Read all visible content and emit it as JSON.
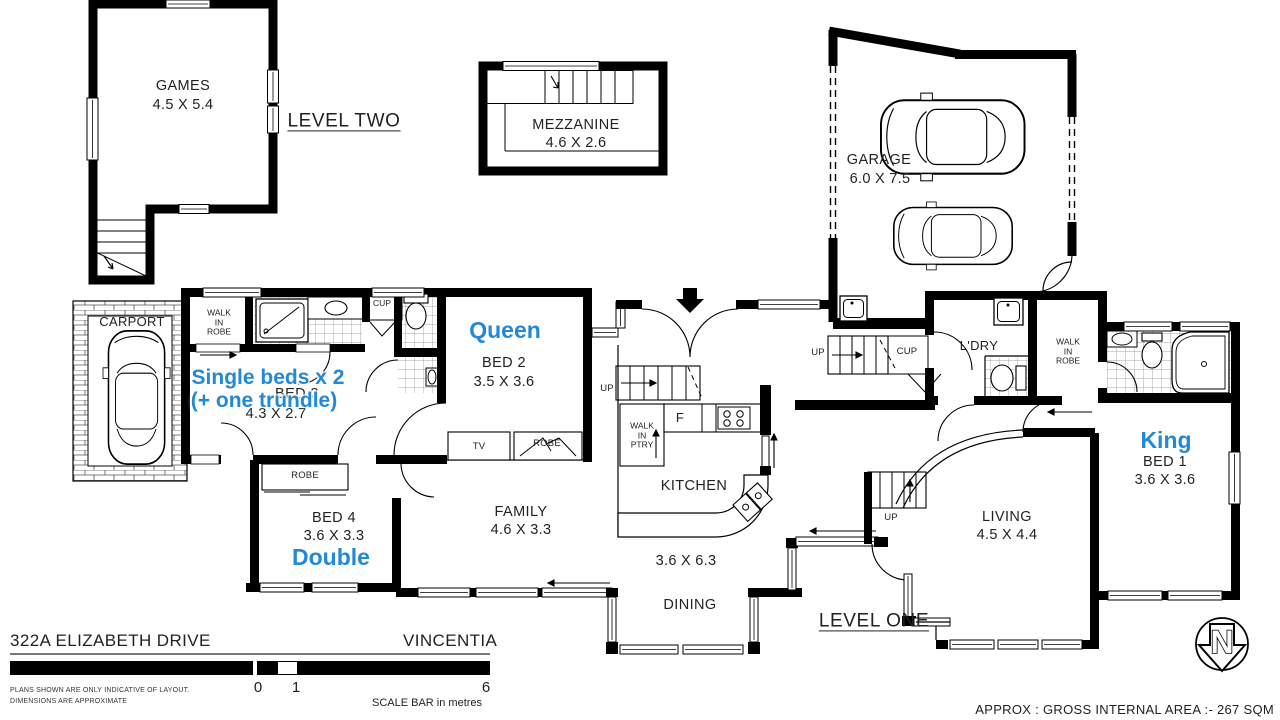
{
  "colors": {
    "wall": "#000000",
    "text": "#222222",
    "annotation_blue": "#2289d8"
  },
  "levels": {
    "level_two": "LEVEL TWO",
    "level_one": "LEVEL ONE"
  },
  "rooms": {
    "games": {
      "name": "GAMES",
      "dims": "4.5 X 5.4"
    },
    "mezzanine": {
      "name": "MEZZANINE",
      "dims": "4.6 X 2.6"
    },
    "garage": {
      "name": "GARAGE",
      "dims": "6.0 X 7.5"
    },
    "carport": {
      "name": "CARPORT"
    },
    "bed1": {
      "name": "BED 1",
      "dims": "3.6 X 3.6"
    },
    "bed2": {
      "name": "BED 2",
      "dims": "3.5 X 3.6"
    },
    "bed3": {
      "name": "BED 3",
      "dims": "4.3 X 2.7"
    },
    "bed4": {
      "name": "BED 4",
      "dims": "3.6 X 3.3"
    },
    "family": {
      "name": "FAMILY",
      "dims": "4.6 X 3.3"
    },
    "kitchen": {
      "name": "KITCHEN"
    },
    "dining": {
      "name": "DINING",
      "dims": "3.6 X 6.3"
    },
    "living": {
      "name": "LIVING",
      "dims": "4.5 X 4.4"
    },
    "laundry": {
      "name": "L'DRY"
    }
  },
  "annotations": {
    "queen": "Queen",
    "king": "King",
    "double": "Double",
    "single_beds_line1": "Single beds x 2",
    "single_beds_line2": "(+ one trundle)"
  },
  "small_labels": {
    "walk_in_robe": "WALK\nIN\nROBE",
    "walk_in_pantry": "WALK\nIN\nPTRY",
    "robe": "ROBE",
    "cup": "CUP",
    "tv": "TV",
    "up": "UP",
    "fridge": "F"
  },
  "footer": {
    "address": "322A ELIZABETH DRIVE",
    "suburb": "VINCENTIA",
    "disclaimer_line1": "PLANS SHOWN ARE ONLY INDICATIVE OF LAYOUT.",
    "disclaimer_line2": "DIMENSIONS ARE APPROXIMATE",
    "scale": {
      "start": "0",
      "one": "1",
      "end": "6",
      "caption": "SCALE BAR in metres"
    }
  },
  "notes": {
    "area": "APPROX : GROSS INTERNAL AREA :- 267 SQM"
  },
  "north": {
    "letter": "N"
  }
}
